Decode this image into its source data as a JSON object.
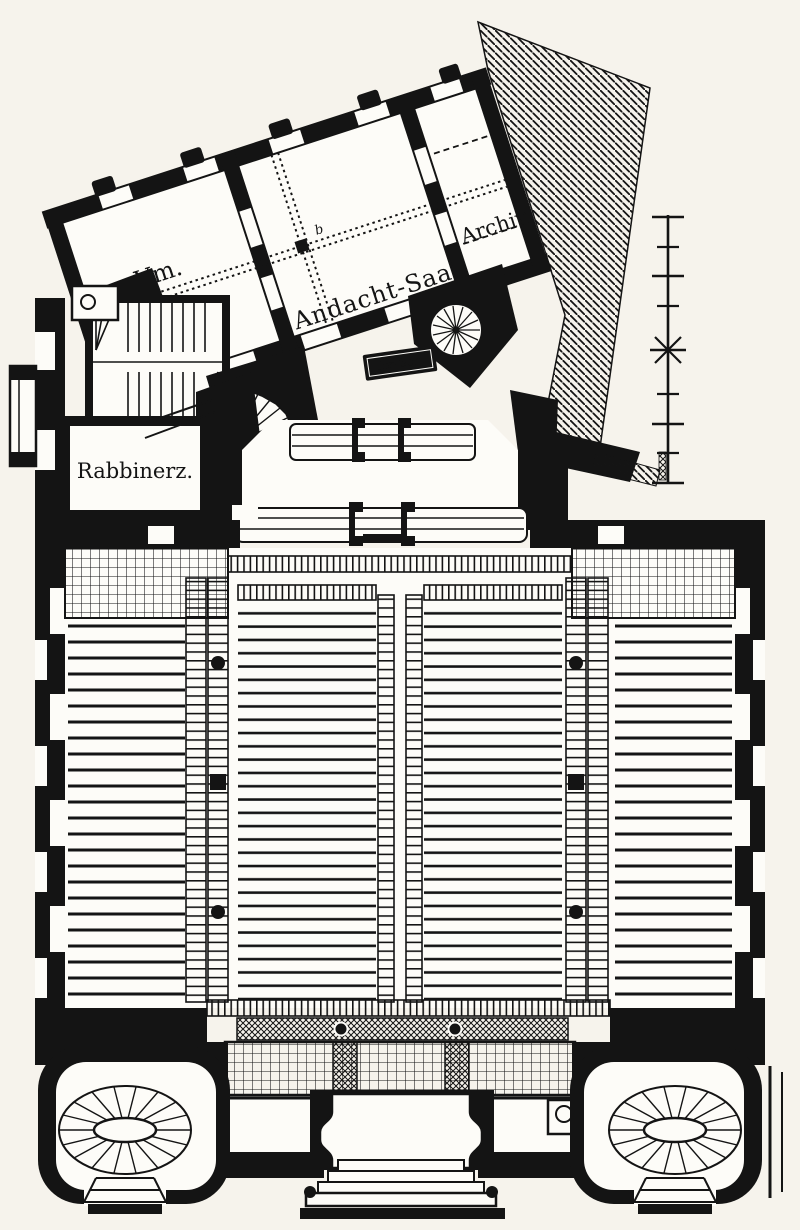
{
  "plan": {
    "type": "architectural-floor-plan",
    "labels": {
      "vm": "Vm.",
      "andacht_saal": "Andacht-Saal",
      "archiv": "Archiv.",
      "rabbinerz": "Rabbinerz.",
      "tor_schrein": "Tor-Sch.",
      "marker_b": "b"
    },
    "scale_bar": {
      "tick_count": 10
    },
    "colors": {
      "paper": "#f6f3ec",
      "plan_white": "#fdfcf8",
      "ink": "#141414"
    }
  }
}
